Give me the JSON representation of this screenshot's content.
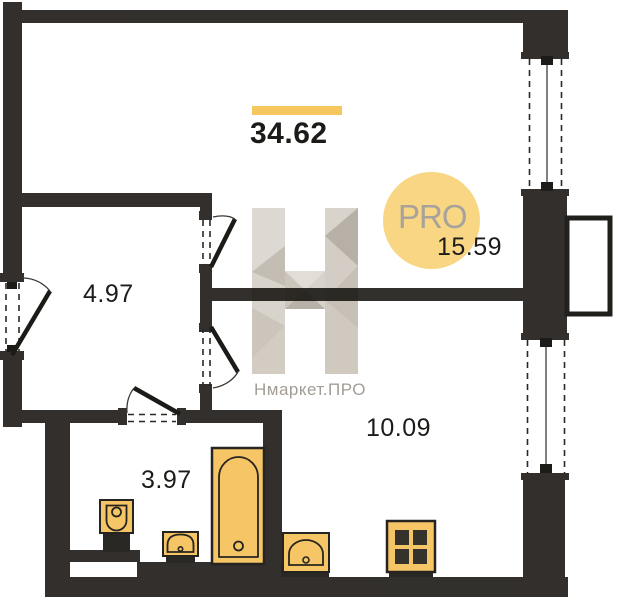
{
  "plan": {
    "type": "apartment-floor-plan",
    "total_area": "34.62",
    "rooms": [
      {
        "id": "living-room",
        "area": "15.59"
      },
      {
        "id": "hallway",
        "area": "4.97"
      },
      {
        "id": "kitchen",
        "area": "10.09"
      },
      {
        "id": "bathroom",
        "area": "3.97"
      }
    ],
    "fixtures": [
      {
        "name": "toilet"
      },
      {
        "name": "washbasin"
      },
      {
        "name": "bathtub"
      },
      {
        "name": "kitchen-sink"
      },
      {
        "name": "stove"
      }
    ],
    "openings": [
      "entrance-door",
      "living-room-door",
      "kitchen-door",
      "bathroom-door",
      "window-top-right",
      "window-bottom-right",
      "balcony-outline"
    ]
  },
  "badge": {
    "label": "PRO"
  },
  "watermark": {
    "brand": "Нмаркет.ПРО",
    "logo": "faceted-H-logo"
  },
  "colors": {
    "wall": "#161310",
    "fixture_fill": "#f6c566",
    "fixture_outline": "#262420",
    "accent_bar": "#f6c65f",
    "badge_background": "#f8d683",
    "badge_text": "#a7a39c",
    "watermark_text": "#a39d96"
  }
}
